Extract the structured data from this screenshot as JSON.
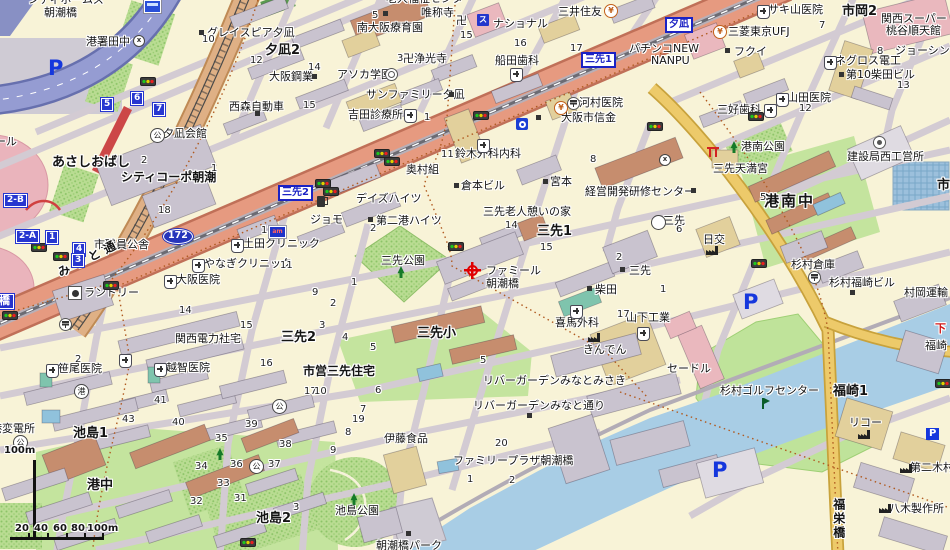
{
  "map": {
    "name": "japanese-city-map",
    "district": "Osaka Minato-ku Misaki / Ikejima / Fukuzaki area"
  },
  "destination": "ファミール朝潮橋",
  "route_shield": "172",
  "scale": {
    "vertical": "100m",
    "ticks": [
      "20",
      "40",
      "60",
      "80",
      "100m"
    ]
  },
  "colors": {
    "road_main": "#e69a80",
    "road_yellow": "#edca6a",
    "expressway": "#959cd2",
    "water": "#a8cde5",
    "park": "#b7da90",
    "sign_blue": "#1b22c4",
    "marker_red": "#e00000"
  },
  "labels": [
    {
      "t": "シティホームズ",
      "x": 28,
      "y": -6
    },
    {
      "t": "朝潮橋",
      "x": 44,
      "y": 7
    },
    {
      "t": "港署田中",
      "x": 86,
      "y": 36
    },
    {
      "t": "グレイスピア夕凪",
      "x": 207,
      "y": 27
    },
    {
      "t": "夕凪2",
      "x": 265,
      "y": 44,
      "k": "b"
    },
    {
      "t": "大阪鋼業",
      "x": 269,
      "y": 71
    },
    {
      "t": "西森自動車",
      "x": 229,
      "y": 101
    },
    {
      "t": "夕凪会館",
      "x": 163,
      "y": 128
    },
    {
      "t": "あさしおばし",
      "x": 52,
      "y": 156,
      "k": "b"
    },
    {
      "t": "シティコーポ朝潮",
      "x": 121,
      "y": 171,
      "k": "b2"
    },
    {
      "t": "市職員公舎",
      "x": 94,
      "y": 239
    },
    {
      "t": "みなと通",
      "x": 56,
      "y": 268,
      "k": "st"
    },
    {
      "t": "ール",
      "x": -5,
      "y": 136
    },
    {
      "t": "土田クリニック",
      "x": 243,
      "y": 238
    },
    {
      "t": "やなぎクリニック",
      "x": 204,
      "y": 258
    },
    {
      "t": "大阪医院",
      "x": 176,
      "y": 274
    },
    {
      "t": "ランドリー",
      "x": 84,
      "y": 287
    },
    {
      "t": "笹尾医院",
      "x": 58,
      "y": 363
    },
    {
      "t": "関西電力社宅",
      "x": 175,
      "y": 333
    },
    {
      "t": "越智医院",
      "x": 166,
      "y": 362
    },
    {
      "t": "港変電所",
      "x": -9,
      "y": 423
    },
    {
      "t": "池島1",
      "x": 73,
      "y": 427,
      "k": "b"
    },
    {
      "t": "港中",
      "x": 87,
      "y": 479,
      "k": "b"
    },
    {
      "t": "池島2",
      "x": 256,
      "y": 512,
      "k": "b"
    },
    {
      "t": "池島公園",
      "x": 335,
      "y": 505
    },
    {
      "t": "朝潮橋パーク",
      "x": 376,
      "y": 540
    },
    {
      "t": "市営三先住宅",
      "x": 303,
      "y": 365,
      "k": "b2"
    },
    {
      "t": "三先2",
      "x": 281,
      "y": 331,
      "k": "b"
    },
    {
      "t": "伊藤食品",
      "x": 384,
      "y": 433
    },
    {
      "t": "三先小",
      "x": 417,
      "y": 327,
      "k": "b"
    },
    {
      "t": "リバーガーデンみなとみさき",
      "x": 483,
      "y": 375
    },
    {
      "t": "リバーガーデンみなと通り",
      "x": 473,
      "y": 400
    },
    {
      "t": "ファミリープラザ朝潮橋",
      "x": 453,
      "y": 455
    },
    {
      "t": "老人福祉センター",
      "x": 386,
      "y": -7
    },
    {
      "t": "南大阪療育園",
      "x": 357,
      "y": 22
    },
    {
      "t": "唯称寺",
      "x": 421,
      "y": 7
    },
    {
      "t": "卍",
      "x": 456,
      "y": 15
    },
    {
      "t": "卍浄光寺",
      "x": 403,
      "y": 53
    },
    {
      "t": "アソカ学園",
      "x": 337,
      "y": 69
    },
    {
      "t": "サンファミリー夕凪",
      "x": 366,
      "y": 89
    },
    {
      "t": "吉田診療所",
      "x": 348,
      "y": 109
    },
    {
      "t": "デイズハイツ",
      "x": 356,
      "y": 193
    },
    {
      "t": "ジョモ",
      "x": 310,
      "y": 214
    },
    {
      "t": "第二港ハイツ",
      "x": 376,
      "y": 215
    },
    {
      "t": "三先公園",
      "x": 381,
      "y": 255
    },
    {
      "t": "奥村組",
      "x": 406,
      "y": 164
    },
    {
      "t": "鈴木外科内科",
      "x": 455,
      "y": 148
    },
    {
      "t": "倉本ビル",
      "x": 461,
      "y": 180
    },
    {
      "t": "ナショナル",
      "x": 493,
      "y": 18
    },
    {
      "t": "船田歯科",
      "x": 495,
      "y": 55
    },
    {
      "t": "三井住友",
      "x": 558,
      "y": 6
    },
    {
      "t": "河村医院",
      "x": 579,
      "y": 97
    },
    {
      "t": "大阪市信金",
      "x": 561,
      "y": 112
    },
    {
      "t": "宮本",
      "x": 550,
      "y": 176
    },
    {
      "t": "経営開発研修センター",
      "x": 585,
      "y": 186
    },
    {
      "t": "三先老人憩いの家",
      "x": 483,
      "y": 206
    },
    {
      "t": "三先1",
      "x": 537,
      "y": 225,
      "k": "b"
    },
    {
      "t": "ファミール",
      "x": 486,
      "y": 265
    },
    {
      "t": "朝潮橋",
      "x": 486,
      "y": 278
    },
    {
      "t": "パチンコNEW",
      "x": 629,
      "y": 43
    },
    {
      "t": "NANPU",
      "x": 651,
      "y": 55
    },
    {
      "t": "三菱東京UFJ",
      "x": 728,
      "y": 26
    },
    {
      "t": "フクイ",
      "x": 734,
      "y": 46
    },
    {
      "t": "サキ山医院",
      "x": 768,
      "y": 4
    },
    {
      "t": "市岡2",
      "x": 842,
      "y": 5,
      "k": "b"
    },
    {
      "t": "関西スーパー",
      "x": 881,
      "y": 13
    },
    {
      "t": "桃谷順天館",
      "x": 886,
      "y": 25
    },
    {
      "t": "ジョーシン",
      "x": 895,
      "y": 45
    },
    {
      "t": "ネグロス電工",
      "x": 835,
      "y": 55
    },
    {
      "t": "第10柴田ビル",
      "x": 846,
      "y": 69
    },
    {
      "t": "山田医院",
      "x": 787,
      "y": 92
    },
    {
      "t": "三好歯科",
      "x": 717,
      "y": 104
    },
    {
      "t": "市岡",
      "x": 937,
      "y": 179,
      "k": "b"
    },
    {
      "t": "港南公園",
      "x": 741,
      "y": 141
    },
    {
      "t": "三先天満宮",
      "x": 713,
      "y": 163
    },
    {
      "t": "建設局西工営所",
      "x": 847,
      "y": 151
    },
    {
      "t": "港南中",
      "x": 764,
      "y": 193,
      "k": "B"
    },
    {
      "t": "三先",
      "x": 663,
      "y": 215
    },
    {
      "t": "日交",
      "x": 703,
      "y": 234
    },
    {
      "t": "杉村倉庫",
      "x": 791,
      "y": 259
    },
    {
      "t": "杉村福崎ビル",
      "x": 829,
      "y": 277
    },
    {
      "t": "村岡運輸",
      "x": 904,
      "y": 287
    },
    {
      "t": "柴田",
      "x": 595,
      "y": 284
    },
    {
      "t": "三先",
      "x": 629,
      "y": 265
    },
    {
      "t": "喜馬外科",
      "x": 555,
      "y": 317
    },
    {
      "t": "きんでん",
      "x": 583,
      "y": 344
    },
    {
      "t": "山下工業",
      "x": 626,
      "y": 312
    },
    {
      "t": "セードル",
      "x": 667,
      "y": 363
    },
    {
      "t": "杉村ゴルフセンター",
      "x": 720,
      "y": 385
    },
    {
      "t": "福崎1",
      "x": 833,
      "y": 385,
      "k": "b"
    },
    {
      "t": "リコー",
      "x": 849,
      "y": 417
    },
    {
      "t": "第二木村ビル",
      "x": 910,
      "y": 462
    },
    {
      "t": "八木製作所",
      "x": 889,
      "y": 503
    },
    {
      "t": "福栄橋",
      "x": 831,
      "y": 498,
      "k": "v"
    },
    {
      "t": "福崎",
      "x": 925,
      "y": 340
    },
    {
      "t": "下",
      "x": 935,
      "y": 323,
      "k": "r"
    },
    {
      "t": "三先2",
      "x": 278,
      "y": 185,
      "k": "s"
    },
    {
      "t": "三先1",
      "x": 581,
      "y": 52,
      "k": "s"
    },
    {
      "t": "夕凪",
      "x": 665,
      "y": 17,
      "k": "s"
    },
    {
      "t": "朝潮橋",
      "x": -27,
      "y": 294,
      "k": "S"
    },
    {
      "t": "172",
      "x": 163,
      "y": 229,
      "k": "sh"
    },
    {
      "t": "2-B",
      "x": 4,
      "y": 194,
      "k": "e"
    },
    {
      "t": "2-A",
      "x": 16,
      "y": 230,
      "k": "e"
    },
    {
      "t": "1",
      "x": 46,
      "y": 231,
      "k": "e"
    },
    {
      "t": "4",
      "x": 73,
      "y": 243,
      "k": "e"
    },
    {
      "t": "3",
      "x": 72,
      "y": 254,
      "k": "e"
    },
    {
      "t": "5",
      "x": 101,
      "y": 98,
      "k": "e"
    },
    {
      "t": "6",
      "x": 131,
      "y": 92,
      "k": "e"
    },
    {
      "t": "7",
      "x": 153,
      "y": 103,
      "k": "e"
    },
    {
      "t": "P",
      "x": 48,
      "y": 56,
      "k": "P"
    },
    {
      "t": "P",
      "x": 743,
      "y": 290,
      "k": "P"
    },
    {
      "t": "P",
      "x": 712,
      "y": 458,
      "k": "P"
    },
    {
      "t": "P",
      "x": 926,
      "y": 428,
      "k": "P2"
    },
    {
      "t": "100m",
      "x": 4,
      "y": 445,
      "k": "sc"
    },
    {
      "t": "20",
      "x": 15,
      "y": 523,
      "k": "sc"
    },
    {
      "t": "40",
      "x": 34,
      "y": 523,
      "k": "sc"
    },
    {
      "t": "60",
      "x": 53,
      "y": 523,
      "k": "sc"
    },
    {
      "t": "80",
      "x": 71,
      "y": 523,
      "k": "sc"
    },
    {
      "t": "100m",
      "x": 87,
      "y": 523,
      "k": "sc"
    },
    {
      "t": "10",
      "x": 202,
      "y": 34,
      "k": "n"
    },
    {
      "t": "12",
      "x": 250,
      "y": 55,
      "k": "n"
    },
    {
      "t": "14",
      "x": 308,
      "y": 62,
      "k": "n"
    },
    {
      "t": "15",
      "x": 303,
      "y": 100,
      "k": "n"
    },
    {
      "t": "5",
      "x": 372,
      "y": 10,
      "k": "n"
    },
    {
      "t": "3",
      "x": 397,
      "y": 53,
      "k": "n"
    },
    {
      "t": "15",
      "x": 460,
      "y": 30,
      "k": "n"
    },
    {
      "t": "16",
      "x": 514,
      "y": 38,
      "k": "n"
    },
    {
      "t": "17",
      "x": 570,
      "y": 43,
      "k": "n"
    },
    {
      "t": "1",
      "x": 424,
      "y": 112,
      "k": "n"
    },
    {
      "t": "7",
      "x": 819,
      "y": 20,
      "k": "n"
    },
    {
      "t": "8",
      "x": 877,
      "y": 46,
      "k": "n"
    },
    {
      "t": "13",
      "x": 897,
      "y": 80,
      "k": "n"
    },
    {
      "t": "12",
      "x": 799,
      "y": 103,
      "k": "n"
    },
    {
      "t": "2",
      "x": 141,
      "y": 155,
      "k": "n"
    },
    {
      "t": "1",
      "x": 211,
      "y": 163,
      "k": "n"
    },
    {
      "t": "18",
      "x": 158,
      "y": 205,
      "k": "n"
    },
    {
      "t": "12",
      "x": 261,
      "y": 225,
      "k": "n"
    },
    {
      "t": "11",
      "x": 280,
      "y": 260,
      "k": "n"
    },
    {
      "t": "11",
      "x": 441,
      "y": 149,
      "k": "n"
    },
    {
      "t": "8",
      "x": 590,
      "y": 154,
      "k": "n"
    },
    {
      "t": "14",
      "x": 505,
      "y": 220,
      "k": "n"
    },
    {
      "t": "15",
      "x": 540,
      "y": 242,
      "k": "n"
    },
    {
      "t": "2",
      "x": 370,
      "y": 223,
      "k": "n"
    },
    {
      "t": "1",
      "x": 351,
      "y": 277,
      "k": "n"
    },
    {
      "t": "9",
      "x": 312,
      "y": 287,
      "k": "n"
    },
    {
      "t": "2",
      "x": 330,
      "y": 298,
      "k": "n"
    },
    {
      "t": "2",
      "x": 616,
      "y": 252,
      "k": "n"
    },
    {
      "t": "1",
      "x": 660,
      "y": 284,
      "k": "n"
    },
    {
      "t": "17",
      "x": 617,
      "y": 309,
      "k": "n"
    },
    {
      "t": "6",
      "x": 676,
      "y": 224,
      "k": "n"
    },
    {
      "t": "5",
      "x": 760,
      "y": 192,
      "k": "n"
    },
    {
      "t": "14",
      "x": 179,
      "y": 305,
      "k": "n"
    },
    {
      "t": "15",
      "x": 240,
      "y": 320,
      "k": "n"
    },
    {
      "t": "16",
      "x": 260,
      "y": 358,
      "k": "n"
    },
    {
      "t": "2",
      "x": 75,
      "y": 354,
      "k": "n"
    },
    {
      "t": "41",
      "x": 154,
      "y": 395,
      "k": "n"
    },
    {
      "t": "43",
      "x": 122,
      "y": 414,
      "k": "n"
    },
    {
      "t": "40",
      "x": 172,
      "y": 417,
      "k": "n"
    },
    {
      "t": "39",
      "x": 245,
      "y": 419,
      "k": "n"
    },
    {
      "t": "38",
      "x": 279,
      "y": 439,
      "k": "n"
    },
    {
      "t": "35",
      "x": 215,
      "y": 433,
      "k": "n"
    },
    {
      "t": "36",
      "x": 230,
      "y": 459,
      "k": "n"
    },
    {
      "t": "37",
      "x": 268,
      "y": 459,
      "k": "n"
    },
    {
      "t": "34",
      "x": 195,
      "y": 461,
      "k": "n"
    },
    {
      "t": "33",
      "x": 217,
      "y": 478,
      "k": "n"
    },
    {
      "t": "31",
      "x": 234,
      "y": 493,
      "k": "n"
    },
    {
      "t": "32",
      "x": 190,
      "y": 496,
      "k": "n"
    },
    {
      "t": "3",
      "x": 293,
      "y": 502,
      "k": "n"
    },
    {
      "t": "17",
      "x": 304,
      "y": 386,
      "k": "n"
    },
    {
      "t": "10",
      "x": 314,
      "y": 386,
      "k": "n"
    },
    {
      "t": "6",
      "x": 375,
      "y": 385,
      "k": "n"
    },
    {
      "t": "7",
      "x": 360,
      "y": 404,
      "k": "n"
    },
    {
      "t": "19",
      "x": 352,
      "y": 414,
      "k": "n"
    },
    {
      "t": "8",
      "x": 345,
      "y": 427,
      "k": "n"
    },
    {
      "t": "9",
      "x": 330,
      "y": 445,
      "k": "n"
    },
    {
      "t": "3",
      "x": 319,
      "y": 320,
      "k": "n"
    },
    {
      "t": "4",
      "x": 342,
      "y": 332,
      "k": "n"
    },
    {
      "t": "5",
      "x": 370,
      "y": 342,
      "k": "n"
    },
    {
      "t": "5",
      "x": 480,
      "y": 355,
      "k": "n"
    },
    {
      "t": "20",
      "x": 495,
      "y": 438,
      "k": "n"
    },
    {
      "t": "1",
      "x": 467,
      "y": 474,
      "k": "n"
    },
    {
      "t": "2",
      "x": 509,
      "y": 475,
      "k": "n"
    }
  ],
  "icons": [
    {
      "n": "traffic-light",
      "x": 140,
      "y": 77
    },
    {
      "n": "traffic-light",
      "x": 31,
      "y": 243
    },
    {
      "n": "traffic-light",
      "x": 53,
      "y": 252
    },
    {
      "n": "traffic-light",
      "x": 103,
      "y": 281
    },
    {
      "n": "traffic-light",
      "x": 2,
      "y": 311
    },
    {
      "n": "traffic-light",
      "x": 315,
      "y": 179
    },
    {
      "n": "traffic-light",
      "x": 323,
      "y": 187
    },
    {
      "n": "traffic-light",
      "x": 374,
      "y": 149
    },
    {
      "n": "traffic-light",
      "x": 384,
      "y": 157
    },
    {
      "n": "traffic-light",
      "x": 448,
      "y": 242
    },
    {
      "n": "traffic-light",
      "x": 473,
      "y": 111
    },
    {
      "n": "traffic-light",
      "x": 647,
      "y": 122
    },
    {
      "n": "traffic-light",
      "x": 748,
      "y": 112
    },
    {
      "n": "traffic-light",
      "x": 751,
      "y": 259
    },
    {
      "n": "traffic-light",
      "x": 240,
      "y": 538
    },
    {
      "n": "traffic-light",
      "x": 935,
      "y": 379
    },
    {
      "n": "hospital",
      "x": 231,
      "y": 239
    },
    {
      "n": "hospital",
      "x": 192,
      "y": 259
    },
    {
      "n": "hospital",
      "x": 164,
      "y": 275
    },
    {
      "n": "hospital",
      "x": 46,
      "y": 364
    },
    {
      "n": "hospital",
      "x": 154,
      "y": 363
    },
    {
      "n": "hospital",
      "x": 119,
      "y": 354
    },
    {
      "n": "hospital",
      "x": 570,
      "y": 305
    },
    {
      "n": "hospital",
      "x": 637,
      "y": 327
    },
    {
      "n": "hospital",
      "x": 776,
      "y": 93
    },
    {
      "n": "hospital",
      "x": 764,
      "y": 104
    },
    {
      "n": "hospital",
      "x": 757,
      "y": 5
    },
    {
      "n": "hospital",
      "x": 824,
      "y": 56
    },
    {
      "n": "hospital",
      "x": 477,
      "y": 139
    },
    {
      "n": "hospital",
      "x": 404,
      "y": 109
    },
    {
      "n": "hospital",
      "x": 510,
      "y": 68
    },
    {
      "n": "post",
      "x": 567,
      "y": 97
    },
    {
      "n": "post",
      "x": 808,
      "y": 271
    },
    {
      "n": "post",
      "x": 59,
      "y": 318
    },
    {
      "n": "bank",
      "x": 604,
      "y": 4
    },
    {
      "n": "bank",
      "x": 713,
      "y": 25
    },
    {
      "n": "bank",
      "x": 554,
      "y": 101
    },
    {
      "n": "metro",
      "x": 516,
      "y": 118
    },
    {
      "n": "super",
      "x": 477,
      "y": 14,
      "g": "ス"
    },
    {
      "n": "ampm",
      "x": 269,
      "y": 226,
      "g": "am"
    },
    {
      "n": "gas",
      "x": 317,
      "y": 196
    },
    {
      "n": "factory",
      "x": 706,
      "y": 246
    },
    {
      "n": "factory",
      "x": 588,
      "y": 333
    },
    {
      "n": "factory",
      "x": 858,
      "y": 430
    },
    {
      "n": "factory",
      "x": 900,
      "y": 464
    },
    {
      "n": "factory",
      "x": 879,
      "y": 504
    },
    {
      "n": "tree",
      "x": 396,
      "y": 266
    },
    {
      "n": "tree",
      "x": 729,
      "y": 141
    },
    {
      "n": "tree",
      "x": 215,
      "y": 448
    },
    {
      "n": "tree",
      "x": 349,
      "y": 493
    },
    {
      "n": "flag",
      "x": 759,
      "y": 398
    },
    {
      "n": "torii",
      "x": 707,
      "y": 147
    },
    {
      "n": "gov",
      "x": 873,
      "y": 136
    },
    {
      "n": "police",
      "x": 133,
      "y": 35
    },
    {
      "n": "police",
      "x": 659,
      "y": 154
    },
    {
      "n": "wheel",
      "x": 385,
      "y": 68
    },
    {
      "n": "laundry",
      "x": 68,
      "y": 286
    },
    {
      "n": "circle-glyph",
      "x": 74,
      "y": 384,
      "g": "港"
    },
    {
      "n": "circle-glyph",
      "x": 150,
      "y": 128,
      "g": "公"
    },
    {
      "n": "circle-glyph",
      "x": 272,
      "y": 399,
      "g": "公"
    },
    {
      "n": "circle-glyph",
      "x": 249,
      "y": 459,
      "g": "公"
    },
    {
      "n": "circle-glyph",
      "x": 13,
      "y": 435,
      "g": "公"
    },
    {
      "n": "circle-glyph",
      "x": 651,
      "y": 215,
      "g": ""
    },
    {
      "n": "bus",
      "x": 144,
      "y": 0
    },
    {
      "n": "dest",
      "x": 464,
      "y": 262
    },
    {
      "n": "blk",
      "x": 199,
      "y": 30
    },
    {
      "n": "blk",
      "x": 312,
      "y": 74
    },
    {
      "n": "blk",
      "x": 255,
      "y": 111
    },
    {
      "n": "blk",
      "x": 383,
      "y": 11
    },
    {
      "n": "blk",
      "x": 449,
      "y": 92
    },
    {
      "n": "blk",
      "x": 368,
      "y": 217
    },
    {
      "n": "blk",
      "x": 454,
      "y": 183
    },
    {
      "n": "blk",
      "x": 543,
      "y": 179
    },
    {
      "n": "blk",
      "x": 691,
      "y": 188
    },
    {
      "n": "blk",
      "x": 587,
      "y": 286
    },
    {
      "n": "blk",
      "x": 620,
      "y": 267
    },
    {
      "n": "blk",
      "x": 527,
      "y": 413
    },
    {
      "n": "blk",
      "x": 839,
      "y": 72
    },
    {
      "n": "blk",
      "x": 725,
      "y": 48
    },
    {
      "n": "blk",
      "x": 850,
      "y": 290
    },
    {
      "n": "blk",
      "x": 536,
      "y": 115
    },
    {
      "n": "blk",
      "x": 406,
      "y": 531
    }
  ]
}
